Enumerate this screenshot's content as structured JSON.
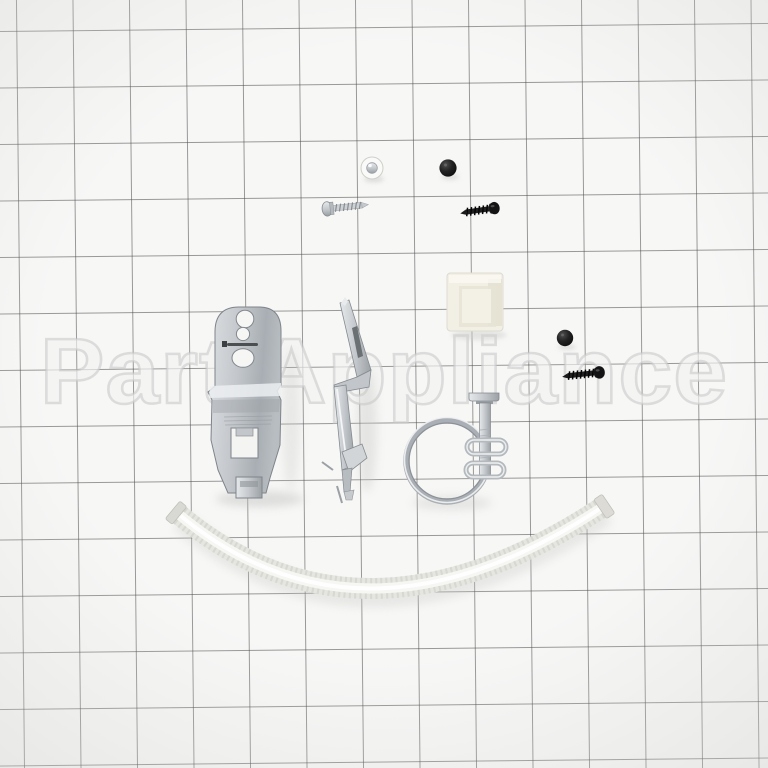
{
  "photo": {
    "description": "Appliance repair kit parts arranged on graph paper",
    "watermark": "Part Appliance",
    "paper_color": "#f7f7f6",
    "grid_line_color": "#4b4b4b",
    "grid_spacing_px": 56,
    "parts": [
      {
        "name": "pan-head-screw-silver-top-view",
        "color": "#f5f5f2"
      },
      {
        "name": "screw-head-black-top-view",
        "color": "#1a1a1a"
      },
      {
        "name": "self-tapping-screw-silver",
        "color": "#c9cdd1"
      },
      {
        "name": "self-tapping-screw-black",
        "color": "#1a1a1a"
      },
      {
        "name": "plastic-spacer-white",
        "color": "#f2f0e4"
      },
      {
        "name": "mounting-bracket-galvanized",
        "color": "#b9bec3"
      },
      {
        "name": "support-bracket-galvanized",
        "color": "#c6cacd"
      },
      {
        "name": "screw-head-black-top-view-2",
        "color": "#1a1a1a"
      },
      {
        "name": "self-tapping-screw-black-2",
        "color": "#1a1a1a"
      },
      {
        "name": "wire-hose-clamp-with-screw",
        "color": "#b4b9be"
      },
      {
        "name": "corrugated-drain-hose-white",
        "color": "#ebebe7"
      }
    ]
  }
}
